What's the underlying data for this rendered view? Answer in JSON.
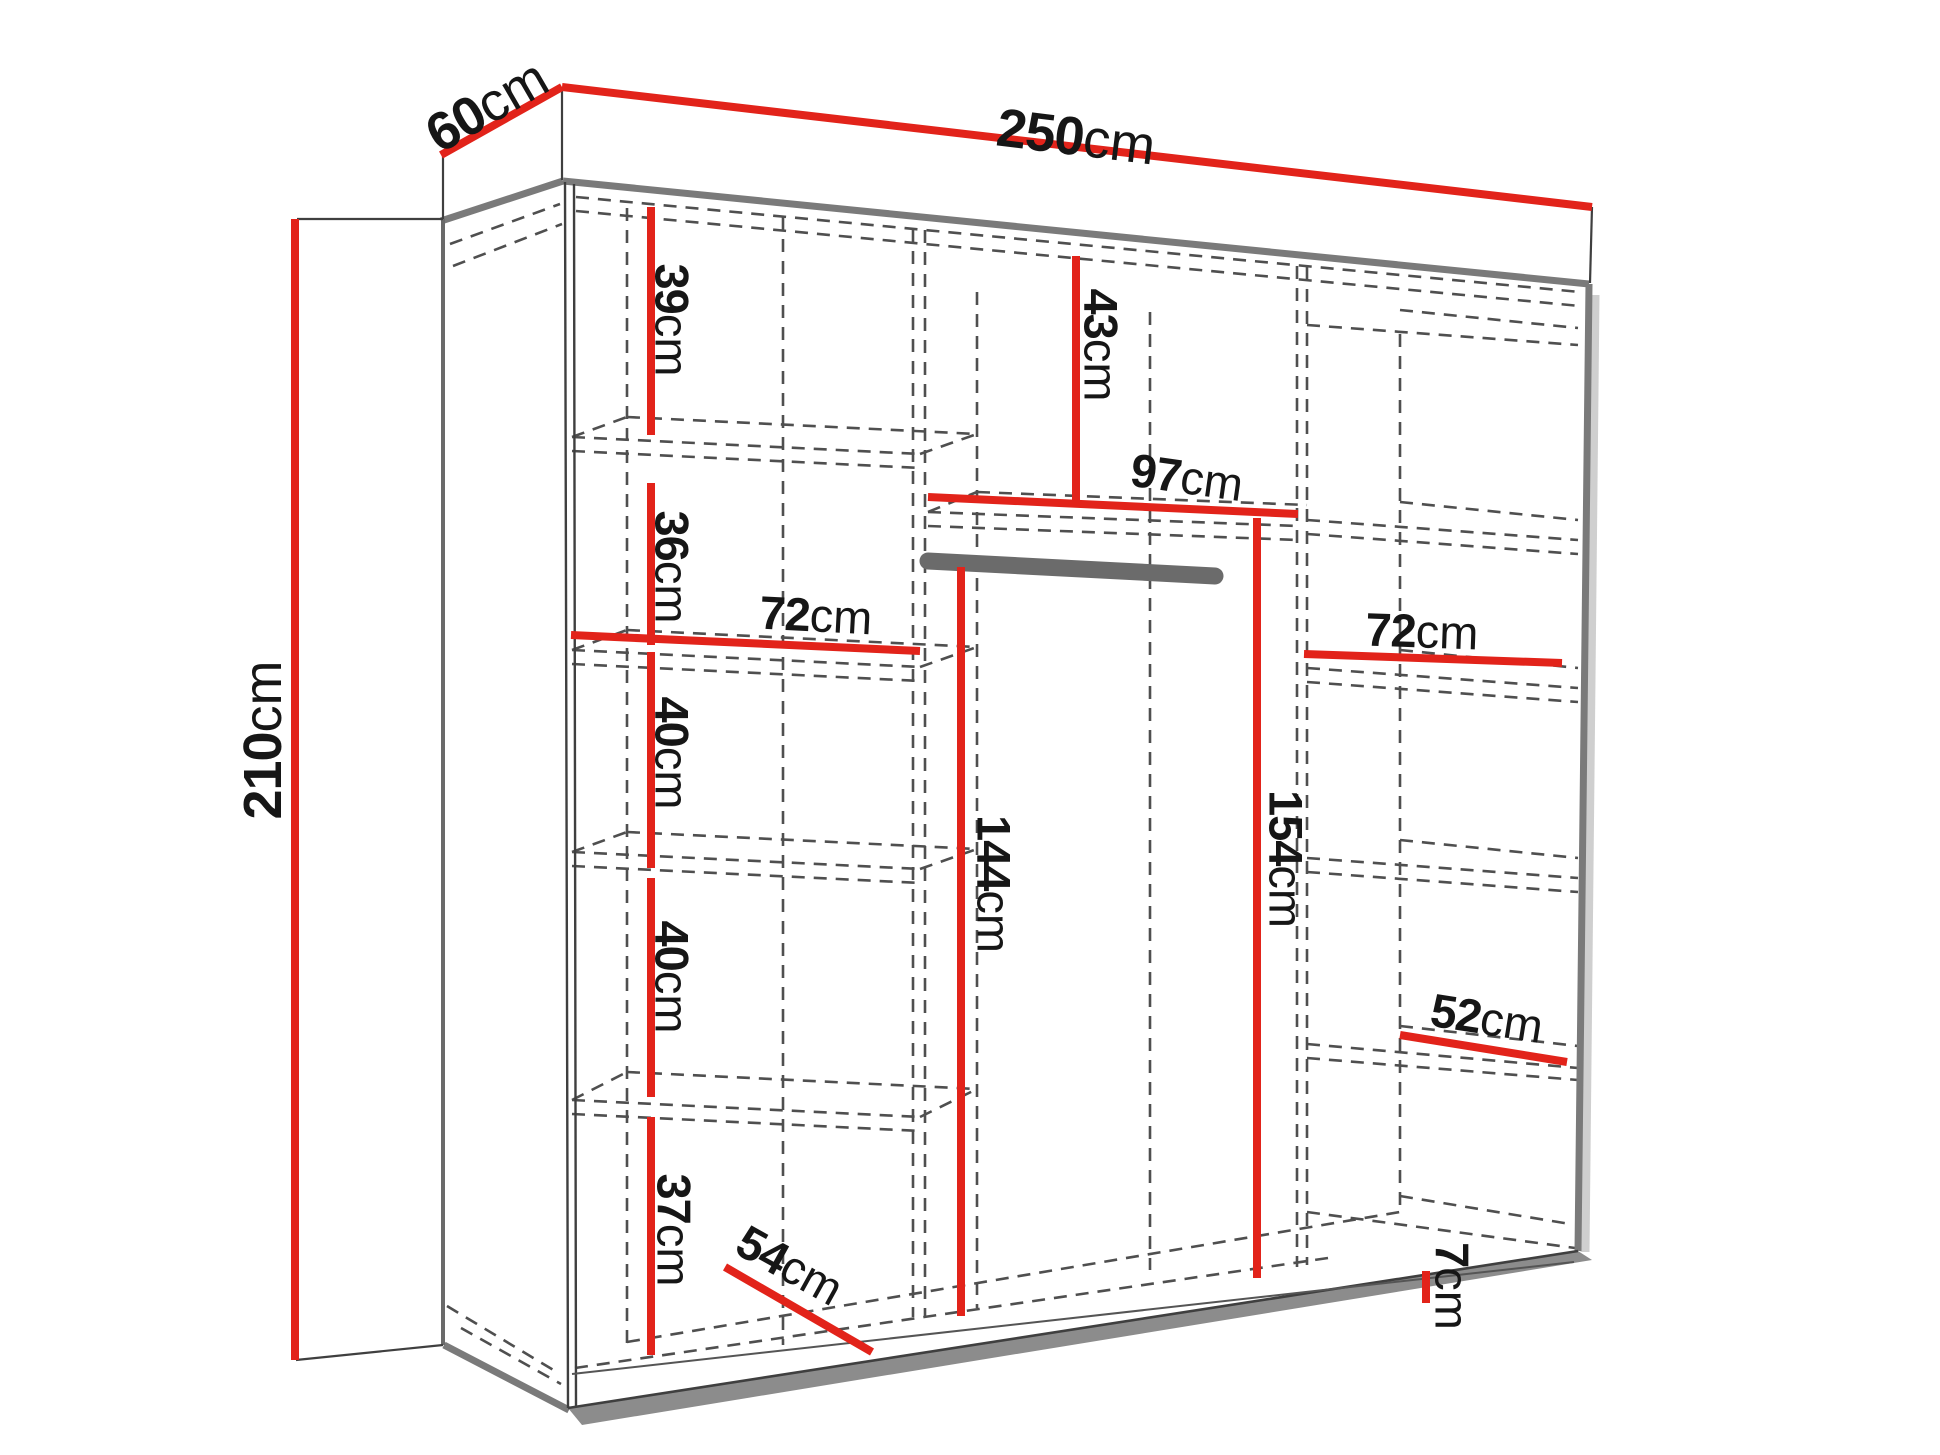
{
  "diagram": {
    "kind": "wardrobe-dimension-diagram",
    "unit": "cm",
    "accent_color": "#e2231a",
    "dash_color": "#4f4f4f",
    "frame_color": "#7a7a7a"
  },
  "labels": {
    "depth": {
      "value": "60",
      "unit": "cm"
    },
    "width": {
      "value": "250",
      "unit": "cm"
    },
    "height": {
      "value": "210",
      "unit": "cm"
    },
    "shelf39": {
      "value": "39",
      "unit": "cm"
    },
    "shelf36": {
      "value": "36",
      "unit": "cm"
    },
    "shelf40a": {
      "value": "40",
      "unit": "cm"
    },
    "shelf40b": {
      "value": "40",
      "unit": "cm"
    },
    "shelf37": {
      "value": "37",
      "unit": "cm"
    },
    "top43": {
      "value": "43",
      "unit": "cm"
    },
    "mid97": {
      "value": "97",
      "unit": "cm"
    },
    "left72": {
      "value": "72",
      "unit": "cm"
    },
    "right72": {
      "value": "72",
      "unit": "cm"
    },
    "hang144": {
      "value": "144",
      "unit": "cm"
    },
    "hang154": {
      "value": "154",
      "unit": "cm"
    },
    "shelf52": {
      "value": "52",
      "unit": "cm"
    },
    "depth54": {
      "value": "54",
      "unit": "cm"
    },
    "plinth7": {
      "value": "7",
      "unit": "cm"
    }
  }
}
